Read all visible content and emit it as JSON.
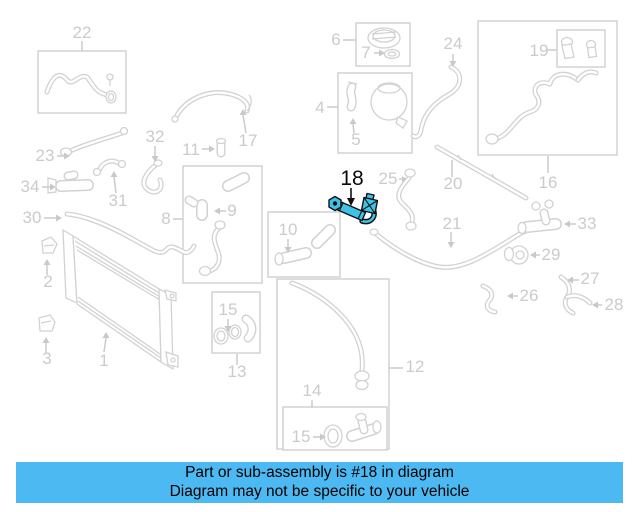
{
  "banner": {
    "line1": "Part or sub-assembly is #18 in diagram",
    "line2": "Diagram may not be specific to your vehicle",
    "background": "#4cb9f2",
    "text_color": "#000000"
  },
  "diagram": {
    "type": "exploded-parts-diagram",
    "highlighted_callout": "18",
    "highlight_color": "#3fc2e5",
    "muted_color": "#d2d2d2",
    "callouts": [
      {
        "label": "22",
        "x": 82,
        "y": 38,
        "highlighted": false
      },
      {
        "label": "23",
        "x": 45,
        "y": 161,
        "highlighted": false
      },
      {
        "label": "32",
        "x": 155,
        "y": 142,
        "highlighted": false
      },
      {
        "label": "31",
        "x": 118,
        "y": 206,
        "highlighted": false
      },
      {
        "label": "34",
        "x": 30,
        "y": 192,
        "highlighted": false
      },
      {
        "label": "30",
        "x": 32,
        "y": 223,
        "highlighted": false
      },
      {
        "label": "11",
        "x": 191,
        "y": 155,
        "highlighted": false
      },
      {
        "label": "17",
        "x": 248,
        "y": 146,
        "highlighted": false
      },
      {
        "label": "8",
        "x": 166,
        "y": 224,
        "highlighted": false
      },
      {
        "label": "9",
        "x": 232,
        "y": 216,
        "highlighted": false
      },
      {
        "label": "10",
        "x": 288,
        "y": 235,
        "highlighted": false
      },
      {
        "label": "6",
        "x": 336,
        "y": 45,
        "highlighted": false
      },
      {
        "label": "7",
        "x": 366,
        "y": 58,
        "highlighted": false
      },
      {
        "label": "24",
        "x": 453,
        "y": 49,
        "highlighted": false
      },
      {
        "label": "19",
        "x": 539,
        "y": 56,
        "highlighted": false
      },
      {
        "label": "16",
        "x": 548,
        "y": 188,
        "highlighted": false
      },
      {
        "label": "4",
        "x": 320,
        "y": 113,
        "highlighted": false
      },
      {
        "label": "5",
        "x": 356,
        "y": 145,
        "highlighted": false
      },
      {
        "label": "18",
        "x": 352,
        "y": 185,
        "highlighted": true
      },
      {
        "label": "25",
        "x": 388,
        "y": 184,
        "highlighted": false
      },
      {
        "label": "20",
        "x": 453,
        "y": 189,
        "highlighted": false
      },
      {
        "label": "21",
        "x": 452,
        "y": 229,
        "highlighted": false
      },
      {
        "label": "33",
        "x": 587,
        "y": 229,
        "highlighted": false
      },
      {
        "label": "29",
        "x": 551,
        "y": 260,
        "highlighted": false
      },
      {
        "label": "26",
        "x": 529,
        "y": 301,
        "highlighted": false
      },
      {
        "label": "27",
        "x": 590,
        "y": 284,
        "highlighted": false
      },
      {
        "label": "28",
        "x": 614,
        "y": 310,
        "highlighted": false
      },
      {
        "label": "2",
        "x": 48,
        "y": 287,
        "highlighted": false
      },
      {
        "label": "3",
        "x": 47,
        "y": 364,
        "highlighted": false
      },
      {
        "label": "1",
        "x": 104,
        "y": 366,
        "highlighted": false
      },
      {
        "label": "15",
        "x": 228,
        "y": 315,
        "highlighted": false
      },
      {
        "label": "13",
        "x": 237,
        "y": 377,
        "highlighted": false
      },
      {
        "label": "12",
        "x": 415,
        "y": 372,
        "highlighted": false
      },
      {
        "label": "14",
        "x": 312,
        "y": 396,
        "highlighted": false
      },
      {
        "label": "15",
        "x": 301,
        "y": 442,
        "highlighted": false
      }
    ]
  }
}
